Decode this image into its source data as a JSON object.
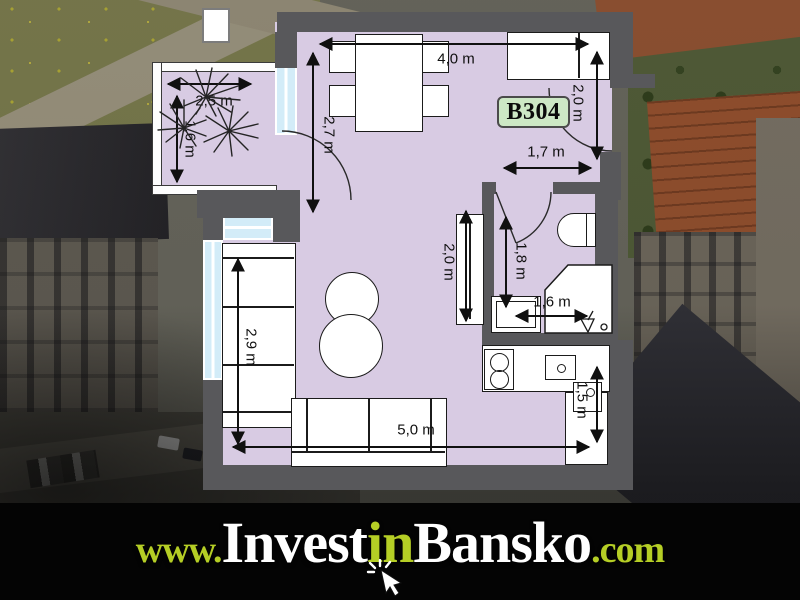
{
  "unit": {
    "label": "B304"
  },
  "brand": {
    "prefix": "www.",
    "part1": "Invest",
    "part2": "in",
    "part3": "Bansko",
    "suffix": ".com"
  },
  "dims": [
    {
      "name": "dining-width",
      "label": "4,0 m"
    },
    {
      "name": "dining-depth",
      "label": "2,7 m"
    },
    {
      "name": "entry-side",
      "label": "2,0 m"
    },
    {
      "name": "entry-width",
      "label": "1,7 m"
    },
    {
      "name": "wardrobe-length",
      "label": "2,0 m"
    },
    {
      "name": "bathroom-length",
      "label": "1,8 m"
    },
    {
      "name": "bathroom-width",
      "label": "1,6 m"
    },
    {
      "name": "kitchen-depth",
      "label": "1,5 m"
    },
    {
      "name": "living-width",
      "label": "5,0 m"
    },
    {
      "name": "sofa-length",
      "label": "2,9 m"
    },
    {
      "name": "balcony-width",
      "label": "2,5 m"
    },
    {
      "name": "balcony-depth",
      "label": "1,6 m"
    }
  ],
  "colors": {
    "wall": "#58585b",
    "room": "#d8cbe3",
    "window": "#d3ecf8",
    "unit_bg": "#cde8c5",
    "brand_green": "#b5ce25",
    "brand_white": "#ffffff",
    "bar_bg": "#040404"
  }
}
